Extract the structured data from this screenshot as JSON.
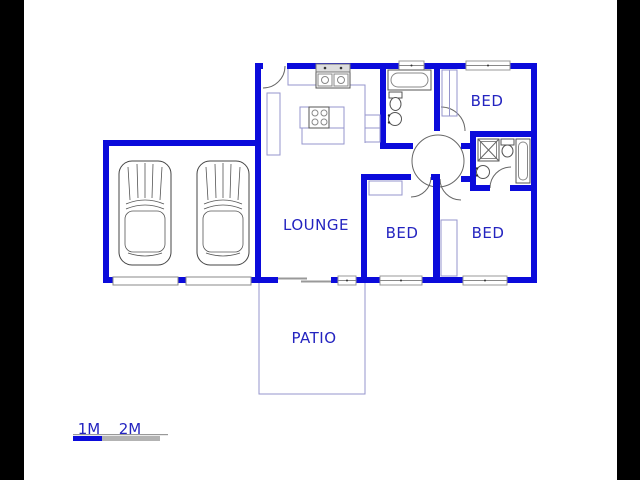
{
  "canvas": {
    "width": 640,
    "height": 480,
    "description": "floor plan drawing"
  },
  "colors": {
    "wall_blue": "#0b0bdb",
    "label_blue": "#2424c0",
    "thin_blue": "#9595cc",
    "fixture_gray": "#555555",
    "scale_gray": "#b3b3b3",
    "canvas_white": "#ffffff",
    "letterbox_black": "#000000"
  },
  "labels": {
    "lounge": "LOUNGE",
    "bed": "BED",
    "patio": "PATIO"
  },
  "scale_bar": {
    "label_1m": "1M",
    "label_2m": "2M"
  },
  "fixtures": {
    "garage_cars": 2,
    "kitchen": [
      "double-sink",
      "stove-island",
      "counter",
      "cupboard"
    ],
    "bathroom_main": [
      "bathtub",
      "toilet",
      "basin"
    ],
    "bathroom_ensuite": [
      "shower",
      "toilet",
      "bathtub",
      "basin"
    ],
    "bedroom_closets": 3,
    "doors": [
      "entry-door",
      "bathroom-door",
      "bed1-door",
      "bed2-door",
      "bed3-door",
      "ensuite-door",
      "patio-sliding-door"
    ],
    "garage_doors": 2,
    "windows": 5
  }
}
